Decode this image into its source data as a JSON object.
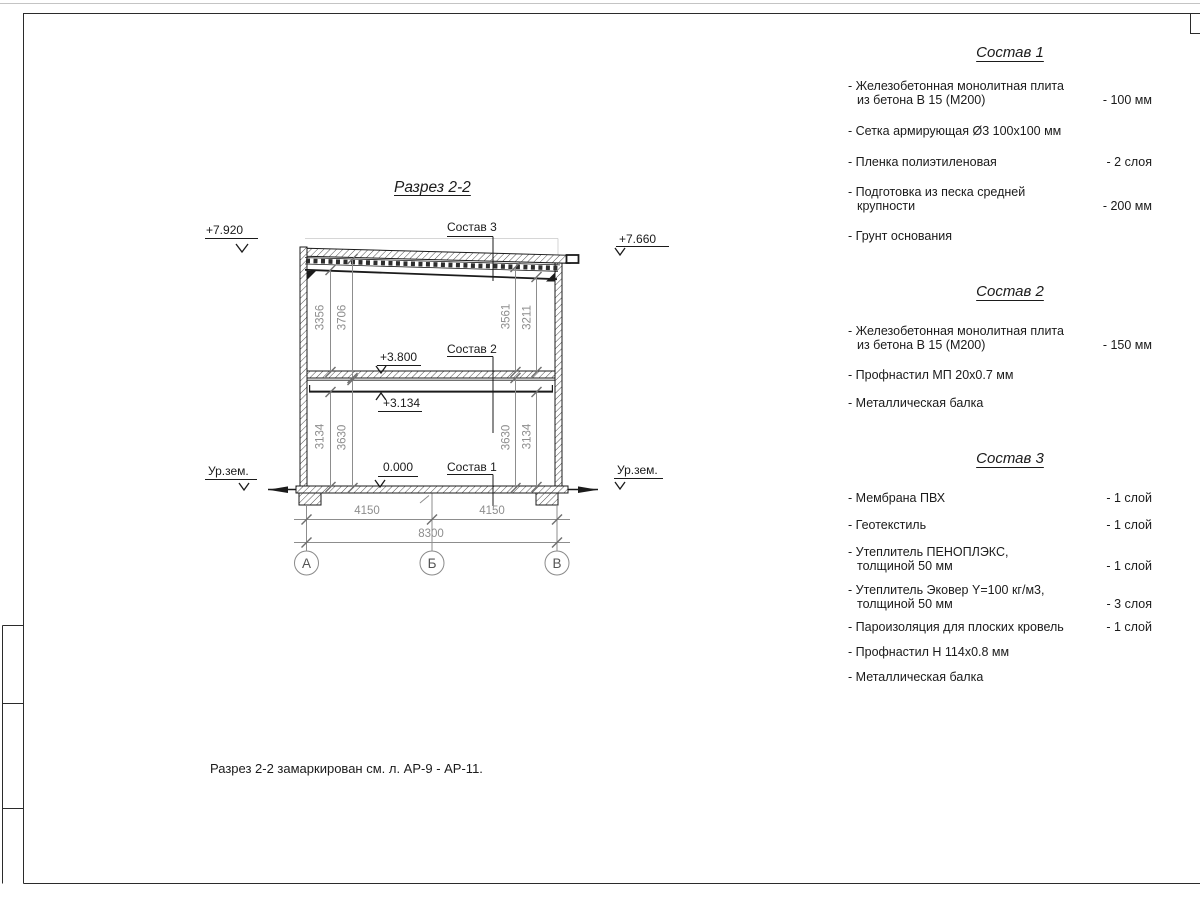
{
  "colors": {
    "ink": "#1b1b1b",
    "dim_gray": "#8d8d8d"
  },
  "sheet": {
    "title": "Разрез 2-2",
    "note": "Разрез 2-2 замаркирован см. л. АР-9 - АР-11."
  },
  "drawing": {
    "elevations": {
      "top_left": "+7.920",
      "top_right": "+7.660",
      "floor2_top": "+3.800",
      "floor2_beam": "+3.134",
      "zero": "0.000",
      "ground_left": "Ур.зем.",
      "ground_right": "Ур.зем."
    },
    "leaders": {
      "roof": "Состав 3",
      "floor": "Состав 2",
      "slab": "Состав 1"
    },
    "vdims": {
      "lu1": "3356",
      "lu2": "3706",
      "ru1": "3561",
      "ru2": "3211",
      "ll1": "3134",
      "ll2": "3630",
      "rl1": "3630",
      "rl2": "3134"
    },
    "hdims": {
      "left": "4150",
      "right": "4150",
      "total": "8300"
    },
    "axes": {
      "a": "А",
      "b": "Б",
      "v": "В"
    }
  },
  "panels": [
    {
      "title": "Состав 1",
      "items": [
        {
          "text": "- Железобетонная  монолитная плита\nиз бетона В 15 (М200)",
          "value": "- 100 мм"
        },
        {
          "text": "- Сетка армирующая Ø3 100x100 мм",
          "value": ""
        },
        {
          "text": "- Пленка полиэтиленовая",
          "value": "- 2 слоя"
        },
        {
          "text": "- Подготовка из песка средней\nкрупности",
          "value": "- 200 мм"
        },
        {
          "text": "- Грунт основания",
          "value": ""
        }
      ]
    },
    {
      "title": "Состав 2",
      "items": [
        {
          "text": "- Железобетонная  монолитная плита\nиз бетона В 15 (М200)",
          "value": "- 150 мм"
        },
        {
          "text": "- Профнастил МП 20x0.7 мм",
          "value": ""
        },
        {
          "text": "- Металлическая балка",
          "value": ""
        }
      ]
    },
    {
      "title": "Состав 3",
      "items": [
        {
          "text": "- Мембрана ПВХ",
          "value": "- 1 слой"
        },
        {
          "text": "- Геотекстиль",
          "value": "- 1 слой"
        },
        {
          "text": "- Утеплитель ПЕНОПЛЭКС,\nтолщиной 50 мм",
          "value": "- 1 слой"
        },
        {
          "text": "- Утеплитель Эковер Y=100 кг/м3,\nтолщиной 50 мм",
          "value": "- 3 слоя"
        },
        {
          "text": "- Пароизоляция для плоских кровель",
          "value": "- 1 слой"
        },
        {
          "text": "- Профнастил Н 114x0.8 мм",
          "value": ""
        },
        {
          "text": "- Металлическая балка",
          "value": ""
        }
      ]
    }
  ]
}
